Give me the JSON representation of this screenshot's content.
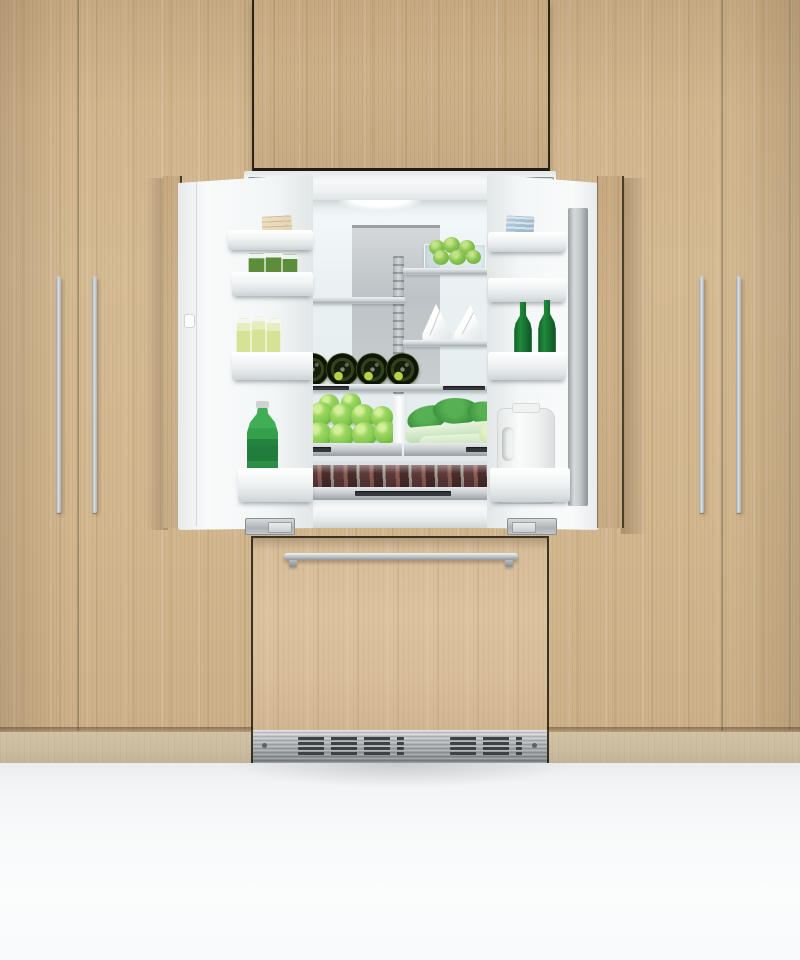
{
  "scene": {
    "type": "product-photograph",
    "subject": "Integrated panel-ready French-door refrigerator with both doors open, built into floor-to-ceiling light oak cabinetry, stocked with green produce and bottles",
    "foreground": "white bench / floor area"
  },
  "palette": {
    "cabinet_wood": "#d2b78f",
    "upper_panel_wood": "#c9ad86",
    "freezer_panel_wood": "#d9be9b",
    "toe_kick_wood": "#cdbd9f",
    "panel_outline": "#2c2517",
    "stainless": "#c3c8cb",
    "fridge_white": "#f4f6f6",
    "interior_backwall": "#e8eff1",
    "floor_white": "#f7f8f9",
    "apple_green": "#84ca4e",
    "lime_green": "#7fbf4b",
    "beer_bottle_green": "#1b7a33",
    "sparkling_bottle_green": "#35a04b",
    "leafy_green": "#3f9640",
    "wine_bottle_green": "#2b3a14",
    "meat_tone": "#6b4340"
  },
  "cabinetry": {
    "left_handle_count": 2,
    "right_handle_count": 2,
    "handle_style": "long vertical stainless bar",
    "door_seam_count": 2
  },
  "refrigerator": {
    "style": "french-door refrigerator with integrated freezer drawer",
    "state": "both fresh-food doors open",
    "freezer_handle": "horizontal stainless bar",
    "vent": "stainless louvre toe grille",
    "left_door_bins": [
      "wrapped deli package",
      "jars of preserved greens",
      "three juice bottles",
      "green sparkling water bottle"
    ],
    "right_door_bins": [
      "frozen pack",
      "empty bin",
      "two green beer bottles",
      "white milk jug"
    ],
    "interior_items": [
      "glass bin of limes",
      "two wrapped paper parcels",
      "four wine bottles on rack",
      "crisper of green apples",
      "crisper of bok choy",
      "vacuum-packed meat drawer"
    ]
  }
}
